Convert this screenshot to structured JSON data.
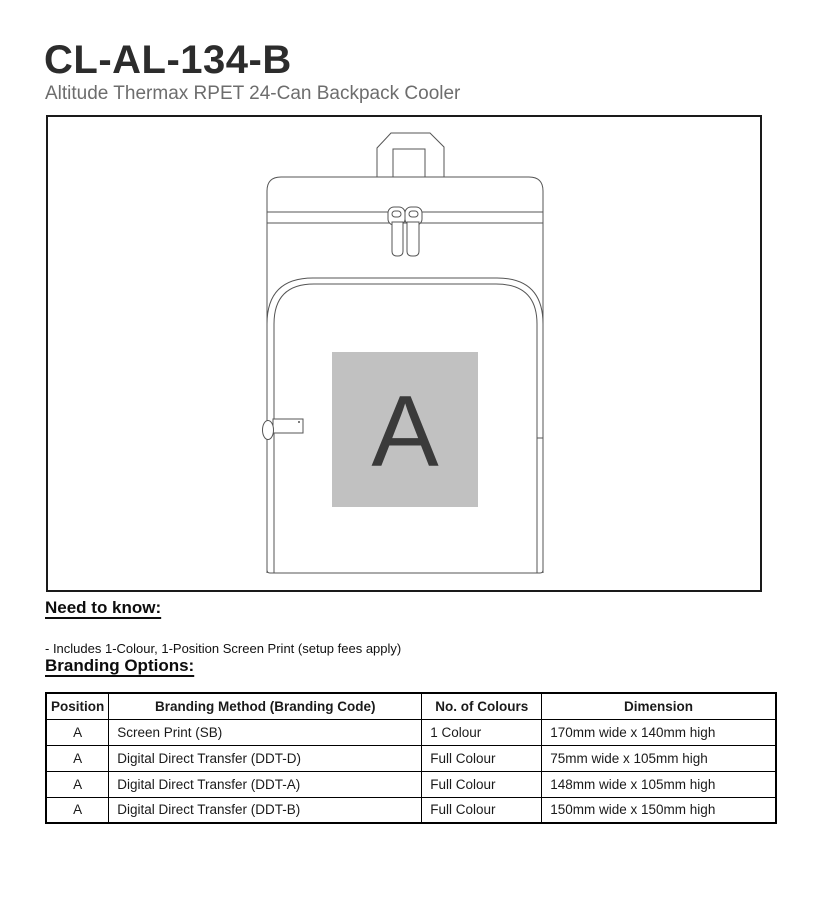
{
  "page": {
    "title": "CL-AL-134-B",
    "subtitle": "Altitude Thermax RPET 24-Can Backpack Cooler"
  },
  "diagram": {
    "description": "line drawing of backpack cooler front view",
    "position_label": "A",
    "marker_bg": "#c1c1c1",
    "marker_letter_color": "#3a3a3a",
    "line_color": "#555555"
  },
  "need_to_know": {
    "heading": "Need to know:",
    "note": "- Includes 1-Colour, 1-Position Screen Print (setup fees apply)"
  },
  "branding_options": {
    "heading": "Branding Options:",
    "table": {
      "headers": [
        "Position",
        "Branding Method (Branding Code)",
        "No. of Colours",
        "Dimension"
      ],
      "rows": [
        [
          "A",
          "Screen Print (SB)",
          "1 Colour",
          "170mm wide x 140mm high"
        ],
        [
          "A",
          "Digital Direct Transfer (DDT-D)",
          "Full Colour",
          "75mm wide x 105mm high"
        ],
        [
          "A",
          "Digital Direct Transfer (DDT-A)",
          "Full Colour",
          "148mm wide x 105mm high"
        ],
        [
          "A",
          "Digital Direct Transfer (DDT-B)",
          "Full Colour",
          "150mm wide x 150mm high"
        ]
      ]
    }
  }
}
